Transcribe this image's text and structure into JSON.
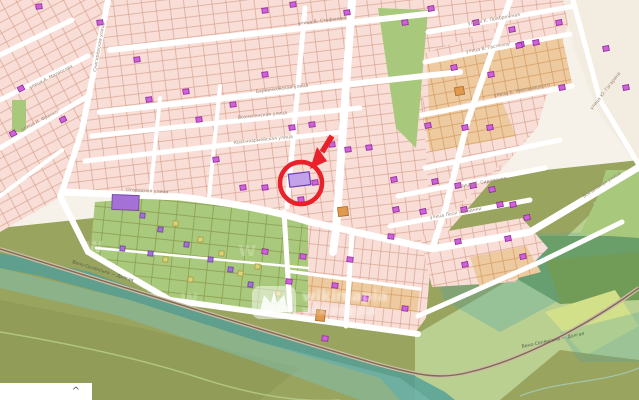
{
  "map": {
    "colors": {
      "background": "#f7f2e9",
      "plot_pink_fill": "#f8ded6",
      "plot_pink_stroke": "#d69a87",
      "plot_tan_fill": "#eecaa0",
      "plot_tan_stroke": "#cf9455",
      "empty_beige": "#f3ece1",
      "park_green": "#a8c97c",
      "garden_green": "#a9ca7c",
      "garden_stroke": "#8d9b4f",
      "forest_dark": "#719c58",
      "fields_light": "#b9d091",
      "yellow_green": "#d2e08a",
      "olive_base": "#99a45f",
      "olive_dark": "#8b9751",
      "water_teal": "#4f9e98",
      "water_light": "#7fbfb6",
      "road_white": "#ffffff",
      "rail_casing": "#cdbda4",
      "rail_line": "#7d6b55",
      "label": "#9b8574",
      "rail_label": "#55604e",
      "annotation_red": "#e8212b",
      "buildings": {
        "m": {
          "f": "#ce63d8",
          "s": "#9327a0"
        },
        "t": {
          "f": "#e09a50",
          "s": "#aa6a22"
        },
        "y": {
          "f": "#dcd47d",
          "s": "#a89b3f"
        },
        "v": {
          "f": "#a471d6",
          "s": "#6d3fa5"
        },
        "hl": {
          "f": "#c4a2e9",
          "s": "#6b3fb2"
        }
      }
    },
    "streets": [
      {
        "d": "M110,50 L435,13",
        "w": 6
      },
      {
        "d": "M100,112 L460,72",
        "w": 6
      },
      {
        "d": "M92,136 L360,108",
        "w": 5
      },
      {
        "d": "M85,161 L340,132",
        "w": 5
      },
      {
        "d": "M62,192 L180,197 Q260,206 310,222 L432,249",
        "w": 7
      },
      {
        "d": "M0,55 L72,20",
        "w": 5
      },
      {
        "d": "M0,100 L88,56",
        "w": 5
      },
      {
        "d": "M0,148 L90,95",
        "w": 5
      },
      {
        "d": "M0,196 L62,150",
        "w": 4
      },
      {
        "d": "M108,0 L82,130 L62,192",
        "w": 6
      },
      {
        "d": "M60,196 L88,252 L170,300 L300,318 L418,334",
        "w": 6
      },
      {
        "d": "M284,212 L290,310",
        "w": 5
      },
      {
        "d": "M160,98 L150,196",
        "w": 4
      },
      {
        "d": "M220,86 L209,197",
        "w": 4
      },
      {
        "d": "M305,8 L287,207",
        "w": 5
      },
      {
        "d": "M352,0 L336,230 L333,252",
        "w": 8
      },
      {
        "d": "M352,236 L346,326",
        "w": 5
      },
      {
        "d": "M287,271 L420,289",
        "w": 3.5
      },
      {
        "d": "M428,32 L575,6",
        "w": 5
      },
      {
        "d": "M425,62 L570,34",
        "w": 5
      },
      {
        "d": "M422,115 L572,86",
        "w": 5
      },
      {
        "d": "M425,168 L560,140",
        "w": 5
      },
      {
        "d": "M398,196 L545,168",
        "w": 5
      },
      {
        "d": "M390,226 L530,200",
        "w": 5
      },
      {
        "d": "M510,0 L468,120 L445,210 L432,249",
        "w": 6
      },
      {
        "d": "M573,0 L600,100 L639,165",
        "w": 5
      },
      {
        "d": "M639,167 L530,232 L432,249",
        "w": 7
      },
      {
        "d": "M418,316 L540,262 L622,222",
        "w": 5
      },
      {
        "d": "M96,248 L308,268",
        "w": 2.5
      }
    ],
    "street_labels": [
      {
        "text": "улица В. Стефаника",
        "x": 298,
        "y": 25,
        "rot": -7
      },
      {
        "text": "Барвинковская улица",
        "x": 256,
        "y": 93,
        "rot": -7
      },
      {
        "text": "Вознесенская улица",
        "x": 238,
        "y": 119,
        "rot": -6
      },
      {
        "text": "Красноармейская улица",
        "x": 234,
        "y": 144,
        "rot": -6
      },
      {
        "text": "Огородная улица",
        "x": 126,
        "y": 191,
        "rot": 3
      },
      {
        "text": "улица К. Прибрежная",
        "x": 468,
        "y": 25,
        "rot": -10
      },
      {
        "text": "улица В. Гастелло",
        "x": 466,
        "y": 53,
        "rot": -10
      },
      {
        "text": "улица Б. Хмельницкого",
        "x": 494,
        "y": 97,
        "rot": -11
      },
      {
        "text": "улица М. Сидоренко",
        "x": 458,
        "y": 188,
        "rot": -10
      },
      {
        "text": "улица Леси Украинки",
        "x": 430,
        "y": 219,
        "rot": -10
      },
      {
        "text": "Вокзальная улица",
        "x": 584,
        "y": 198,
        "rot": -33
      },
      {
        "text": "улица А. Матросова",
        "x": 30,
        "y": 89,
        "rot": -27
      },
      {
        "text": "улица И. Франко",
        "x": 22,
        "y": 131,
        "rot": -27
      },
      {
        "text": "Снигирёвская улица",
        "x": 96,
        "y": 72,
        "rot": -80
      },
      {
        "text": "улица Ю. Гагарина",
        "x": 592,
        "y": 110,
        "rot": -52
      }
    ],
    "railway": {
      "d": "M0,249 C120,286 260,330 370,362 C420,376 440,380 470,372 C520,360 580,330 639,288",
      "label": "Вено-Селянська — Долгая",
      "label_positions": [
        {
          "x": 72,
          "y": 263,
          "rot": 17
        },
        {
          "x": 522,
          "y": 348,
          "rot": -12
        }
      ]
    },
    "buildings": [
      [
        36,
        4,
        "m",
        -7
      ],
      [
        97,
        20,
        "m",
        -7
      ],
      [
        134,
        57,
        "m",
        -7
      ],
      [
        262,
        8,
        "m",
        -7
      ],
      [
        290,
        2,
        "m",
        -7
      ],
      [
        344,
        10,
        "m",
        -7
      ],
      [
        402,
        20,
        "m",
        -7
      ],
      [
        428,
        6,
        "m",
        -10
      ],
      [
        473,
        20,
        "m",
        -10
      ],
      [
        518,
        42,
        "m",
        -10
      ],
      [
        556,
        20,
        "m",
        -10
      ],
      [
        603,
        46,
        "m",
        -10
      ],
      [
        559,
        85,
        "m",
        -10
      ],
      [
        623,
        85,
        "m",
        -10
      ],
      [
        18,
        86,
        "m",
        -27
      ],
      [
        60,
        117,
        "m",
        -27
      ],
      [
        10,
        131,
        "m",
        -27
      ],
      [
        146,
        97,
        "m",
        -7
      ],
      [
        183,
        89,
        "m",
        -7
      ],
      [
        196,
        117,
        "m",
        -7
      ],
      [
        230,
        102,
        "m",
        -7
      ],
      [
        262,
        72,
        "m",
        -7
      ],
      [
        289,
        125,
        "m",
        -7
      ],
      [
        309,
        122,
        "m",
        -7
      ],
      [
        329,
        142,
        "m",
        -7
      ],
      [
        345,
        147,
        "m",
        -7
      ],
      [
        366,
        145,
        "m",
        -7
      ],
      [
        425,
        123,
        "m",
        -10
      ],
      [
        451,
        65,
        "m",
        -10
      ],
      [
        488,
        72,
        "m",
        -10
      ],
      [
        462,
        125,
        "m",
        -10
      ],
      [
        487,
        125,
        "m",
        -10
      ],
      [
        509,
        27,
        "m",
        -10
      ],
      [
        516,
        43,
        "m",
        -10
      ],
      [
        533,
        40,
        "m",
        -10
      ],
      [
        213,
        157,
        "m",
        -7
      ],
      [
        240,
        185,
        "m",
        -7
      ],
      [
        262,
        185,
        "m",
        -7
      ],
      [
        312,
        180,
        "m",
        -7
      ],
      [
        298,
        197,
        "m",
        -7
      ],
      [
        391,
        177,
        "m",
        -10
      ],
      [
        420,
        209,
        "m",
        -10
      ],
      [
        393,
        207,
        "m",
        -10
      ],
      [
        432,
        179,
        "m",
        -10
      ],
      [
        455,
        183,
        "m",
        -10
      ],
      [
        470,
        183,
        "m",
        -10
      ],
      [
        489,
        187,
        "m",
        -10
      ],
      [
        497,
        202,
        "m",
        -10
      ],
      [
        510,
        202,
        "m",
        -10
      ],
      [
        524,
        215,
        "m",
        -10
      ],
      [
        461,
        207,
        "m",
        -10
      ],
      [
        388,
        234,
        "m",
        6
      ],
      [
        262,
        249,
        "m",
        6
      ],
      [
        300,
        254,
        "m",
        6
      ],
      [
        347,
        257,
        "m",
        6
      ],
      [
        286,
        279,
        "m",
        6
      ],
      [
        332,
        283,
        "m",
        6
      ],
      [
        362,
        296,
        "m",
        6
      ],
      [
        402,
        306,
        "m",
        6
      ],
      [
        322,
        336,
        "m",
        6
      ],
      [
        455,
        239,
        "m",
        -10
      ],
      [
        505,
        236,
        "m",
        -10
      ],
      [
        462,
        262,
        "m",
        -10
      ],
      [
        520,
        254,
        "m",
        -10
      ],
      [
        140,
        213,
        "v",
        6,
        5,
        5
      ],
      [
        158,
        227,
        "v",
        6,
        5,
        5
      ],
      [
        184,
        242,
        "v",
        6,
        5,
        5
      ],
      [
        208,
        257,
        "v",
        6,
        5,
        5
      ],
      [
        148,
        251,
        "v",
        6,
        5,
        5
      ],
      [
        228,
        267,
        "v",
        6,
        5,
        5
      ],
      [
        248,
        282,
        "v",
        6,
        5,
        5
      ],
      [
        120,
        246,
        "v",
        6,
        5,
        5
      ],
      [
        173,
        221,
        "y",
        6,
        5,
        5
      ],
      [
        198,
        237,
        "y",
        6,
        5,
        5
      ],
      [
        219,
        251,
        "y",
        6,
        5,
        5
      ],
      [
        163,
        257,
        "y",
        6,
        5,
        5
      ],
      [
        238,
        271,
        "y",
        6,
        5,
        5
      ],
      [
        188,
        277,
        "y",
        6,
        5,
        5
      ],
      [
        276,
        291,
        "y",
        6,
        5,
        5
      ],
      [
        255,
        264,
        "y",
        6,
        5,
        5
      ],
      [
        455,
        87,
        "t",
        -10,
        9,
        8
      ],
      [
        338,
        207,
        "t",
        -7,
        10,
        9
      ],
      [
        316,
        310,
        "t",
        6,
        9,
        11
      ],
      [
        112,
        195,
        "v",
        2,
        27,
        15
      ]
    ],
    "highlight_building": {
      "x": 289,
      "y": 173,
      "w": 21,
      "h": 13,
      "rot": -7
    },
    "annotation": {
      "circle": {
        "cx": 301,
        "cy": 183,
        "r": 21,
        "stroke_width": 4.5
      },
      "arrow": {
        "shaft": "M332,136 L322,152",
        "shaft_width": 5.5,
        "head": "M310,169 L327,161 L317,147 Z"
      }
    },
    "watermark": {
      "text": "wikimapia",
      "mini_glyph": "w",
      "mini_positions": [
        {
          "x": 85,
          "y": 252,
          "size": 20,
          "opacity": 0.22
        },
        {
          "x": 238,
          "y": 256,
          "size": 20,
          "opacity": 0.22
        },
        {
          "x": 180,
          "y": 304,
          "size": 20,
          "opacity": 0.2
        }
      ]
    },
    "attribution": {
      "caret": "^"
    }
  }
}
